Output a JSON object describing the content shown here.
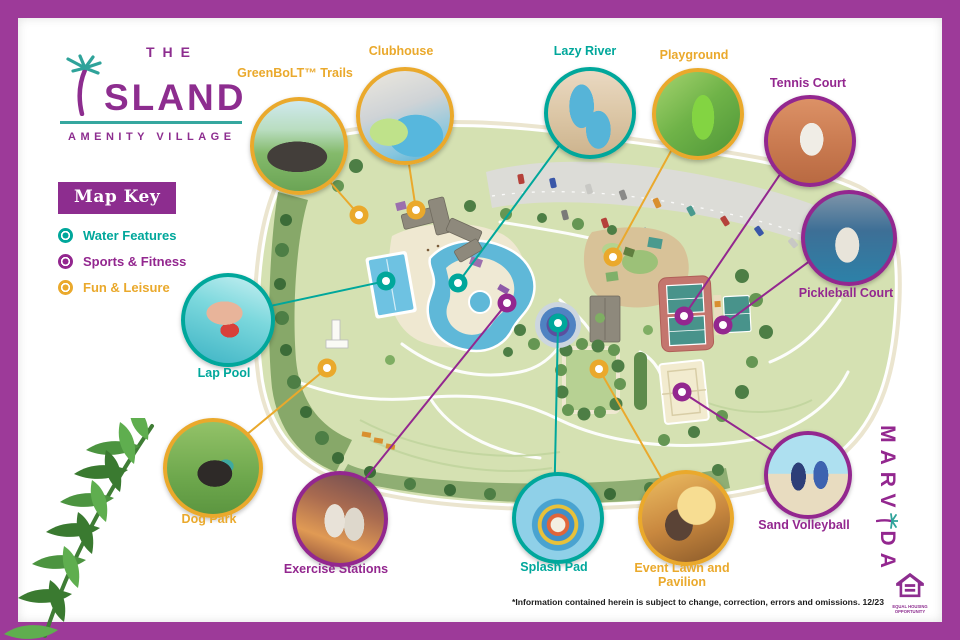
{
  "brand": {
    "line1": "THE",
    "palm_icon": "palm-tree-forms-letter-I",
    "name_rest": "SLAND",
    "tagline": "AMENITY VILLAGE"
  },
  "map_key": {
    "title": "Map Key",
    "items": [
      {
        "label": "Water Features",
        "color": "#00a79b"
      },
      {
        "label": "Sports & Fitness",
        "color": "#93278f"
      },
      {
        "label": "Fun & Leisure",
        "color": "#eaa92c"
      }
    ]
  },
  "callouts": [
    {
      "label": "GreenBoLT™ Trails",
      "category": "Fun & Leisure",
      "color": "#eaa92c"
    },
    {
      "label": "Clubhouse",
      "category": "Fun & Leisure",
      "color": "#eaa92c"
    },
    {
      "label": "Lazy River",
      "category": "Water Features",
      "color": "#00a79b"
    },
    {
      "label": "Playground",
      "category": "Fun & Leisure",
      "color": "#eaa92c"
    },
    {
      "label": "Tennis Court",
      "category": "Sports & Fitness",
      "color": "#93278f"
    },
    {
      "label": "Pickleball Court",
      "category": "Sports & Fitness",
      "color": "#93278f"
    },
    {
      "label": "Lap Pool",
      "category": "Water Features",
      "color": "#00a79b"
    },
    {
      "label": "Dog Park",
      "category": "Fun & Leisure",
      "color": "#eaa92c"
    },
    {
      "label": "Exercise Stations",
      "category": "Sports & Fitness",
      "color": "#93278f"
    },
    {
      "label": "Splash Pad",
      "category": "Water Features",
      "color": "#00a79b"
    },
    {
      "label": "Event Lawn and Pavilion",
      "category": "Fun & Leisure",
      "color": "#eaa92c"
    },
    {
      "label": "Sand Volleyball",
      "category": "Sports & Fitness",
      "color": "#93278f"
    }
  ],
  "marvida": {
    "part1": "MARV",
    "palm_icon": "palm-tree-forms-letter-I",
    "part2": "DA"
  },
  "footer": {
    "disclaimer": "*Information contained herein is subject to change, correction, errors and omissions. 12/23",
    "equal_housing_line1": "EQUAL HOUSING",
    "equal_housing_line2": "OPPORTUNITY"
  },
  "colors": {
    "frame": "#9d3a99",
    "teal": "#00a79b",
    "purple": "#93278f",
    "gold": "#eaa92c"
  }
}
